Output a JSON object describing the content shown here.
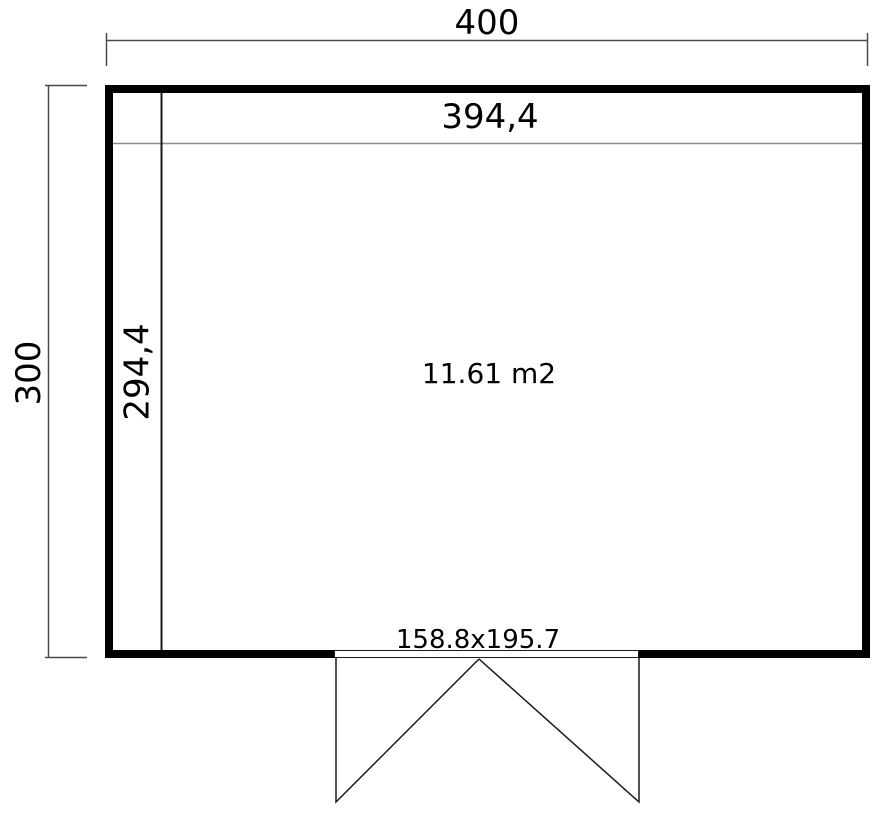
{
  "floorplan": {
    "outer_width_label": "400",
    "outer_height_label": "300",
    "inner_width_label": "394,4",
    "inner_height_label": "294,4",
    "area_label": "11.61 m2",
    "door_label": "158.8x195.7",
    "colors": {
      "wall": "#000000",
      "outline": "#1a1a1a",
      "dimension_line": "#4a4a4a",
      "inner_guide_line": "#8a8a8a",
      "background": "#ffffff",
      "text": "#000000"
    }
  }
}
